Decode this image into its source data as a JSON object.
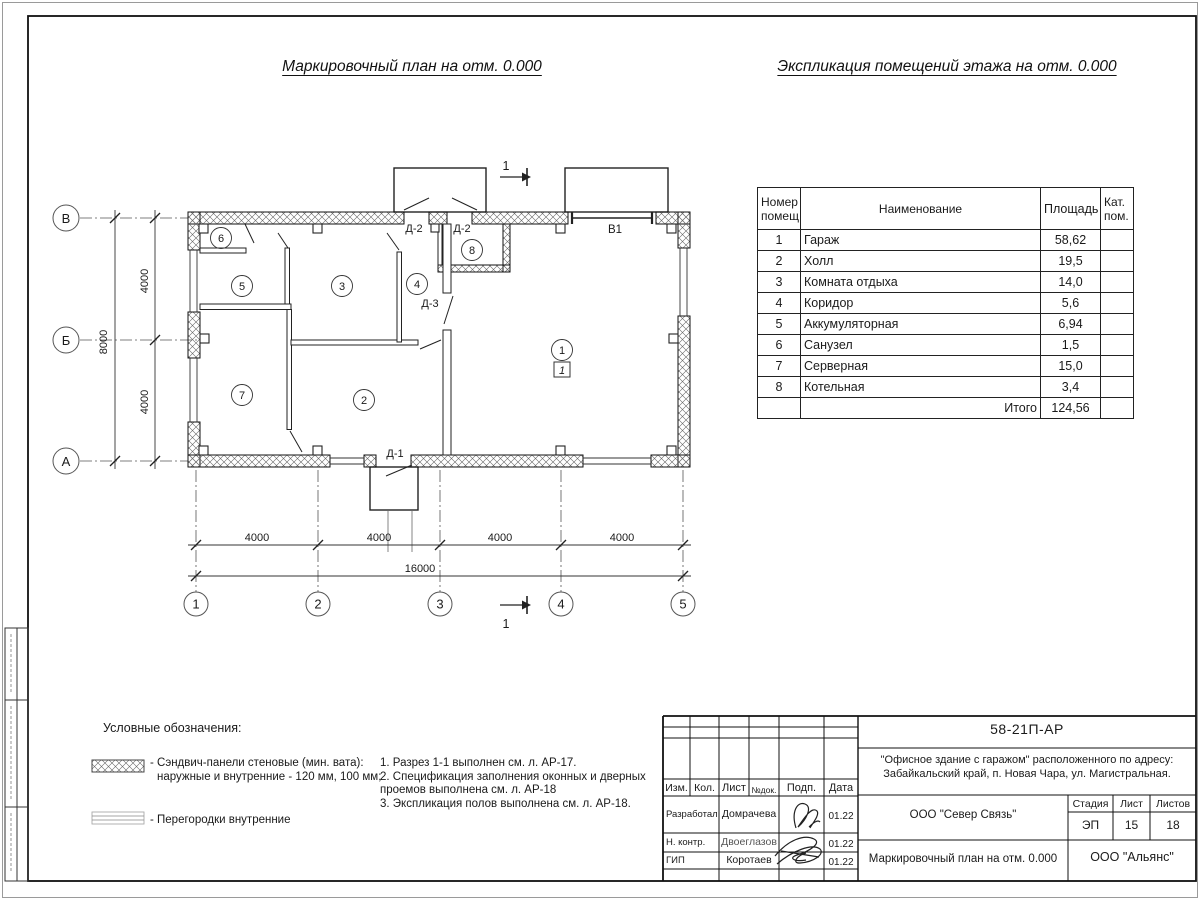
{
  "titles": {
    "plan": "Маркировочный план на отм. 0.000",
    "table": "Экспликация помещений этажа на отм. 0.000"
  },
  "explication": {
    "col_num_l1": "Номер",
    "col_num_l2": "помещ.",
    "col_name": "Наименование",
    "col_area": "Площадь",
    "col_cat_l1": "Кат.",
    "col_cat_l2": "пом.",
    "rows": [
      {
        "n": "1",
        "name": "Гараж",
        "area": "58,62"
      },
      {
        "n": "2",
        "name": "Холл",
        "area": "19,5"
      },
      {
        "n": "3",
        "name": "Комната отдыха",
        "area": "14,0"
      },
      {
        "n": "4",
        "name": "Коридор",
        "area": "5,6"
      },
      {
        "n": "5",
        "name": "Аккумуляторная",
        "area": "6,94"
      },
      {
        "n": "6",
        "name": "Санузел",
        "area": "1,5"
      },
      {
        "n": "7",
        "name": "Серверная",
        "area": "15,0"
      },
      {
        "n": "8",
        "name": "Котельная",
        "area": "3,4"
      }
    ],
    "total_label": "Итого",
    "total_value": "124,56"
  },
  "plan": {
    "rooms": [
      "1",
      "2",
      "3",
      "4",
      "5",
      "6",
      "7",
      "8"
    ],
    "floor_mark": "1",
    "door_d1": "Д-1",
    "door_d2": "Д-2",
    "door_d3": "Д-3",
    "gate": "В1",
    "section": "1",
    "axes_x": [
      "1",
      "2",
      "3",
      "4",
      "5"
    ],
    "axes_y": [
      "В",
      "Б",
      "А"
    ],
    "dim_4000": "4000",
    "dim_16000": "16000",
    "dim_8000": "8000"
  },
  "legend": {
    "title": "Условные обозначения:",
    "item1_l1": "- Сэндвич-панели стеновые (мин. вата):",
    "item1_l2": "наружные и внутренние - 120 мм, 100 мм;",
    "item2": "- Перегородки внутренние",
    "note1": "1. Разрез 1-1 выполнен см. л. АР-17.",
    "note2": "2. Спецификация заполнения оконных и дверных",
    "note3": "проемов выполнена см. л. АР-18",
    "note4": "3. Экспликация полов выполнена см. л. АР-18."
  },
  "stamp": {
    "doc_number": "58-21П-АР",
    "project_line1": "\"Офисное здание с гаражом\" расположенного по адресу:",
    "project_line2": "Забайкальский край, п. Новая Чара, ул. Магистральная.",
    "org": "ООО \"Север Связь\"",
    "sheet_title": "Маркировочный план на отм. 0.000",
    "contractor": "ООО \"Альянс\"",
    "h_izm": "Изм.",
    "h_kol": "Кол.",
    "h_list": "Лист",
    "h_ndok": "№док.",
    "h_podp": "Подп.",
    "h_data": "Дата",
    "h_stage": "Стадия",
    "h_sheet": "Лист",
    "h_sheets": "Листов",
    "stage": "ЭП",
    "sheet_no": "15",
    "sheets_total": "18",
    "r1_role": "Разработал",
    "r1_name": "Домрачева",
    "r1_date": "01.22",
    "r2_role": "Н. контр.",
    "r2_name": "Двоеглазов",
    "r2_date": "01.22",
    "r3_role": "ГИП",
    "r3_name": "Коротаев",
    "r3_date": "01.22"
  }
}
